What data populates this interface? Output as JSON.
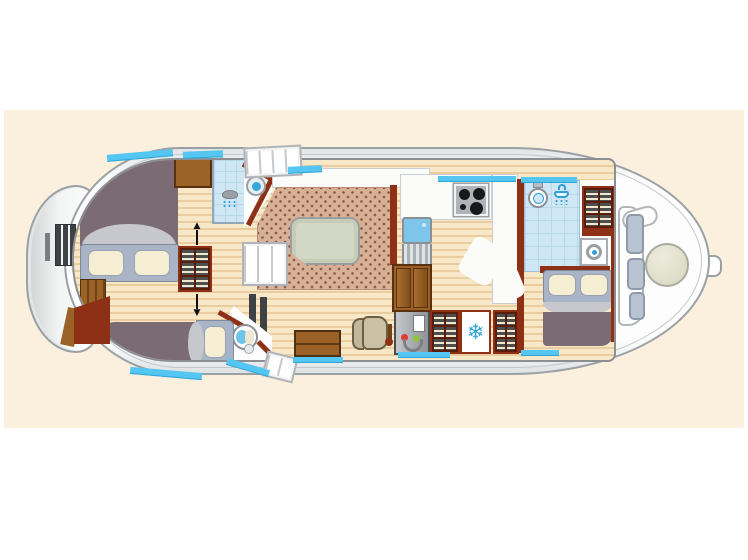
{
  "title": "canal-boat-floor-plan",
  "panel_color": "#fbf0de",
  "icons": {
    "fridge_snowflake": "❄",
    "wardrobe_arrow_up": "▲",
    "wardrobe_arrow_down": "▼"
  },
  "palette": {
    "hull_outline": "#9aa0a4",
    "deck_white": "#fdfdfd",
    "wood_light": "#f8e8c8",
    "wood_dark": "#e9cda1",
    "wall_red": "#8e3016",
    "furniture_brown": "#9a6227",
    "bed_blanket_mauve": "#7b6c74",
    "bed_frame_gray": "#a9b4c6",
    "pillow_cream": "#f6eed2",
    "carpet_base": "#d8b096",
    "carpet_dot": "#8d5f4a",
    "window_blue": "#55c5f2",
    "bath_blue": "#cfe7f5",
    "fixture_blue": "#2f9fd8",
    "table_green": "#d3d7c6",
    "console_red_dot": "#e23b2e",
    "console_green_dot": "#8fc43c",
    "cushion_gray": "#b9c4d2"
  },
  "rooms": [
    {
      "name": "forward-cabin",
      "furniture": [
        "double-bed",
        "nightstand",
        "wardrobe",
        "dresser"
      ]
    },
    {
      "name": "forward-shower-room",
      "furniture": [
        "shower",
        "porthole-sink"
      ]
    },
    {
      "name": "second-cabin",
      "furniture": [
        "single-bed",
        "toilet",
        "radiator"
      ]
    },
    {
      "name": "salon",
      "furniture": [
        "carpet",
        "table",
        "settee-steps",
        "chest-steps",
        "helm-stool",
        "helm-console",
        "throttle-lever"
      ]
    },
    {
      "name": "galley",
      "furniture": [
        "hob",
        "sink",
        "drainer",
        "counter",
        "lower-cabinet",
        "shelf-cabinet",
        "fridge",
        "shelf-cabinet"
      ]
    },
    {
      "name": "aft-bathroom",
      "furniture": [
        "toilet",
        "shower",
        "washbasin",
        "shelf-cabinet"
      ]
    },
    {
      "name": "aft-cabin",
      "furniture": [
        "double-bed"
      ]
    },
    {
      "name": "stern-deck",
      "furniture": [
        "bench",
        "cushions",
        "round-table",
        "rudder"
      ]
    },
    {
      "name": "bow-exterior",
      "furniture": [
        "boarding-ladder"
      ]
    }
  ],
  "window_strips": 10,
  "stairs": [
    "top-companionway",
    "bottom-companionway"
  ]
}
